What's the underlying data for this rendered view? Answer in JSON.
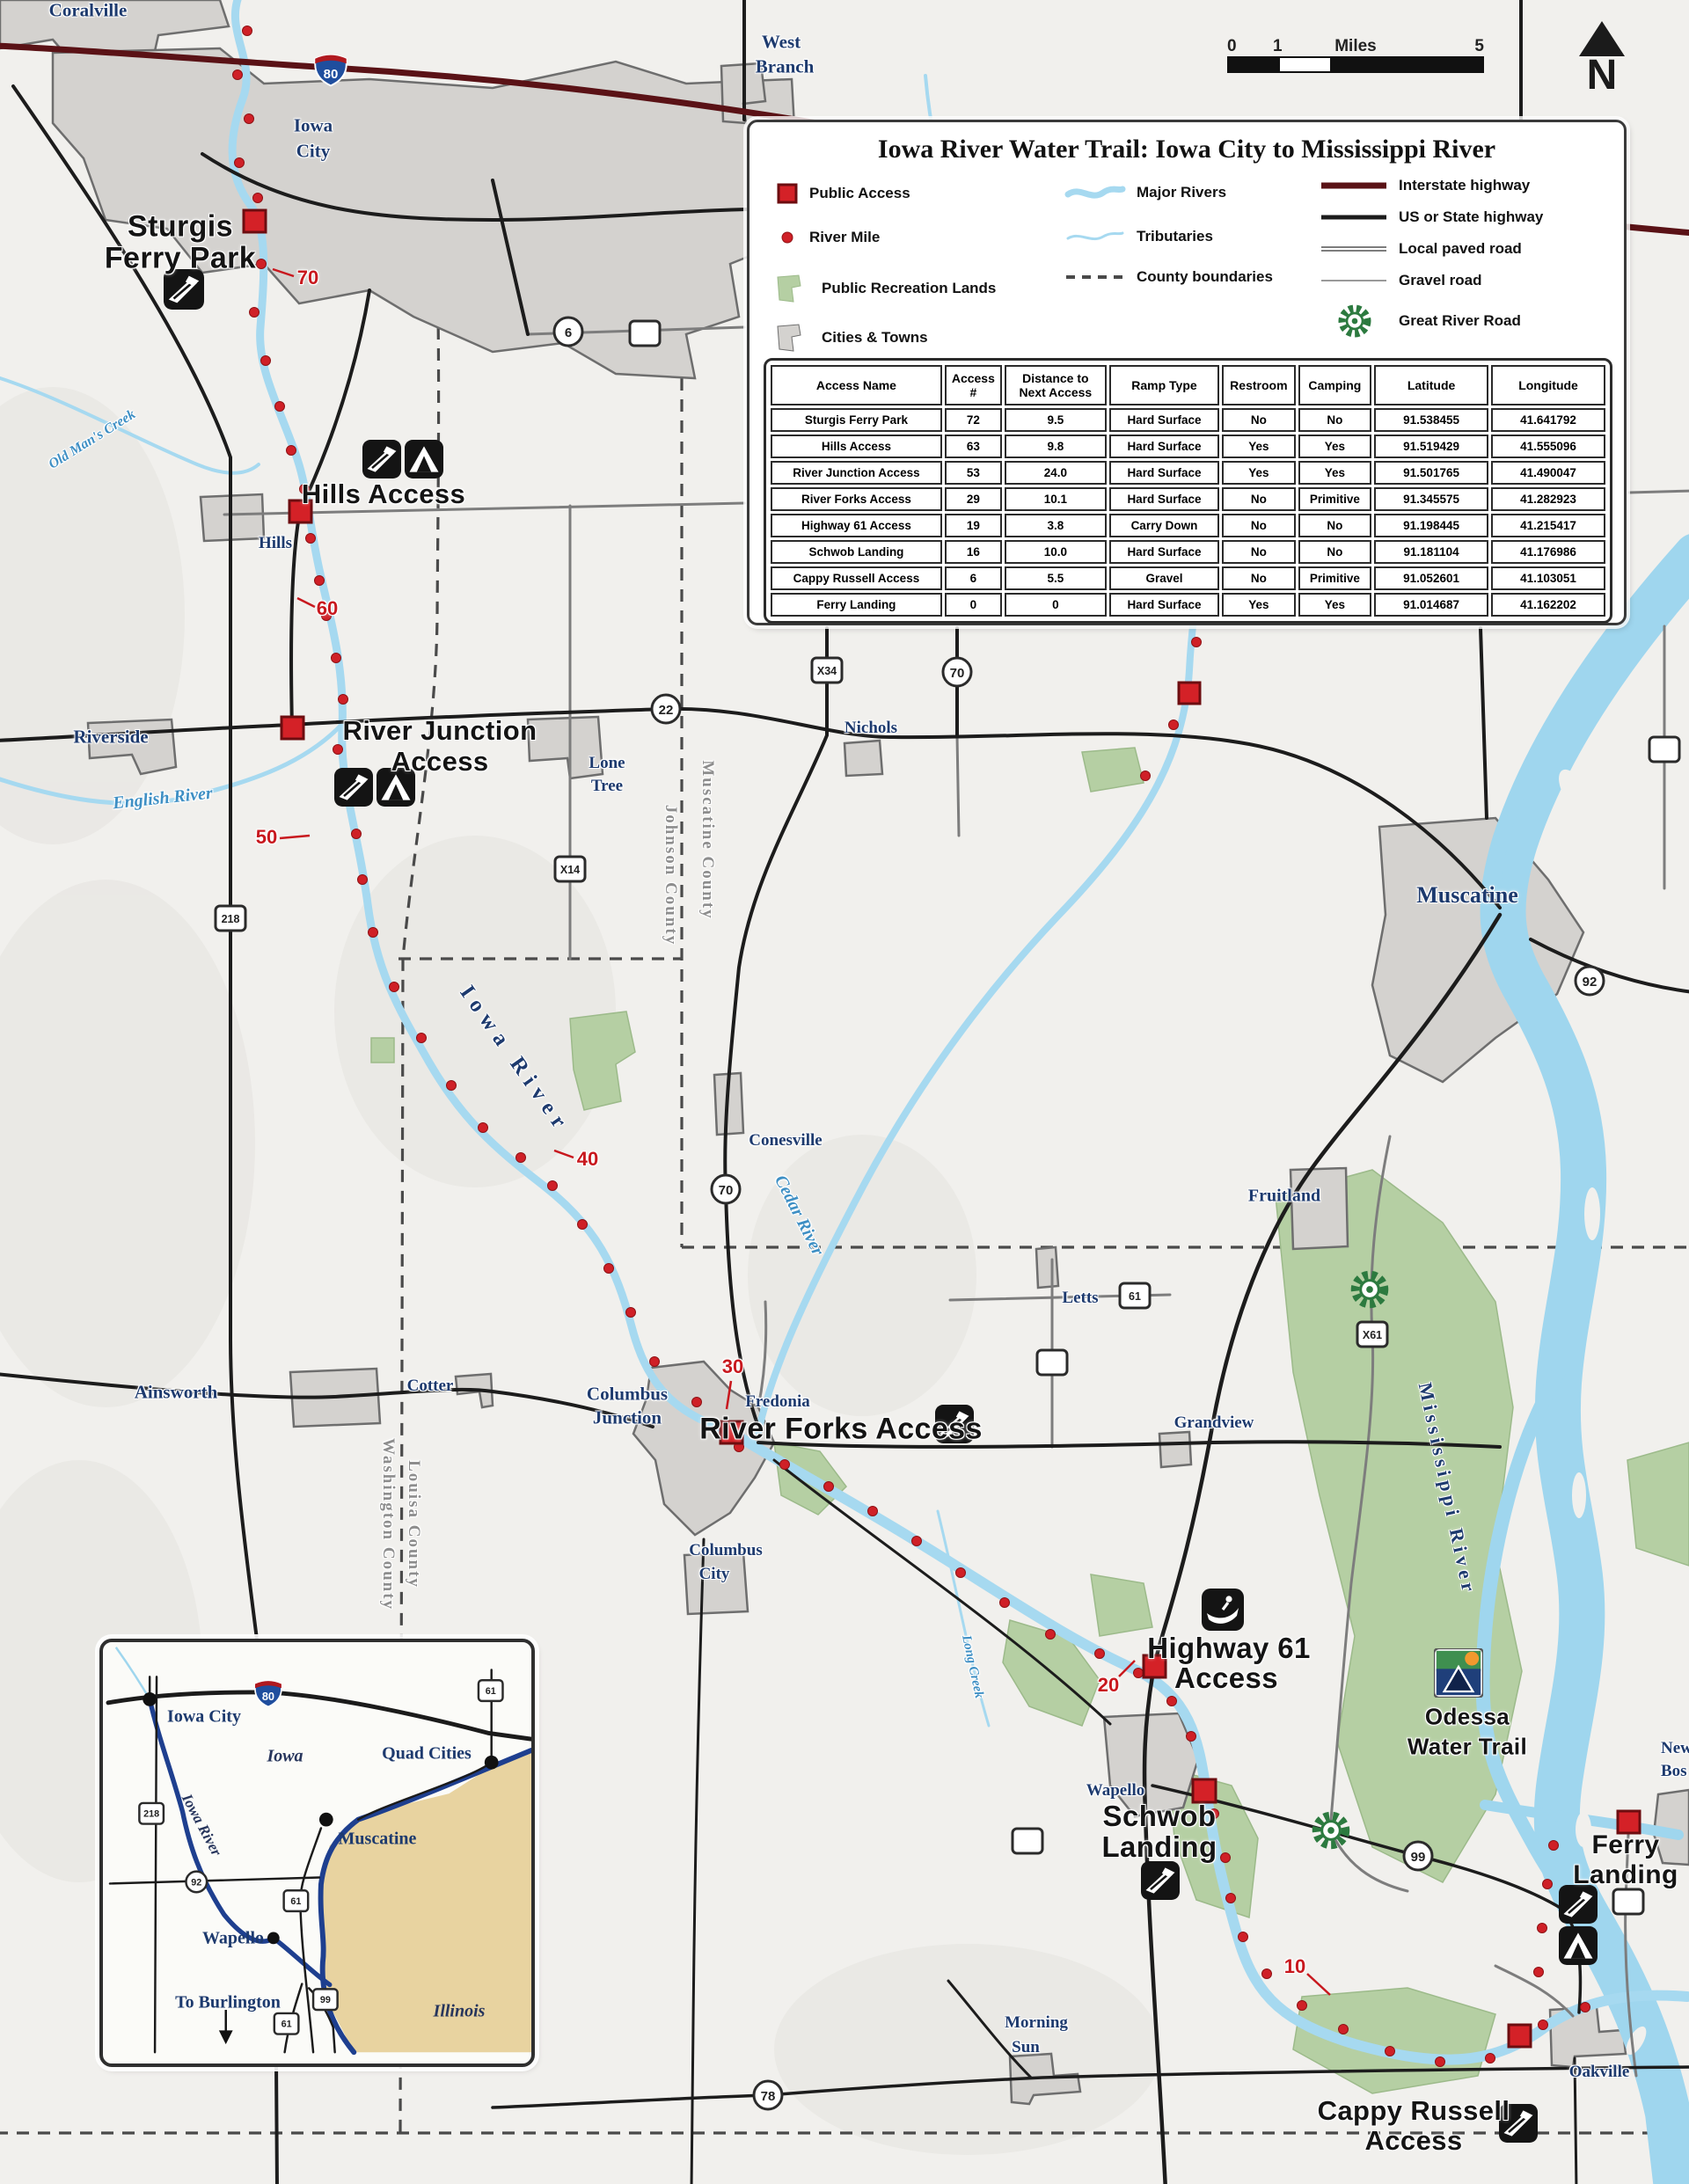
{
  "legend": {
    "title": "Iowa River Water Trail: Iowa City to Mississippi River",
    "items": {
      "public_access": "Public Access",
      "river_mile": "River Mile",
      "rec_lands": "Public Recreation Lands",
      "cities_towns": "Cities & Towns",
      "major_rivers": "Major Rivers",
      "tributaries": "Tributaries",
      "county_boundaries": "County boundaries",
      "interstate": "Interstate highway",
      "us_state": "US or State highway",
      "local_paved": "Local paved road",
      "gravel": "Gravel road",
      "great_river_road": "Great River Road"
    }
  },
  "table": {
    "headers": [
      "Access Name",
      "Access\n#",
      "Distance to\nNext Access",
      "Ramp Type",
      "Restroom",
      "Camping",
      "Latitude",
      "Longitude"
    ],
    "rows": [
      [
        "Sturgis Ferry Park",
        "72",
        "9.5",
        "Hard Surface",
        "No",
        "No",
        "91.538455",
        "41.641792"
      ],
      [
        "Hills Access",
        "63",
        "9.8",
        "Hard Surface",
        "Yes",
        "Yes",
        "91.519429",
        "41.555096"
      ],
      [
        "River Junction Access",
        "53",
        "24.0",
        "Hard Surface",
        "Yes",
        "Yes",
        "91.501765",
        "41.490047"
      ],
      [
        "River Forks Access",
        "29",
        "10.1",
        "Hard Surface",
        "No",
        "Primitive",
        "91.345575",
        "41.282923"
      ],
      [
        "Highway 61 Access",
        "19",
        "3.8",
        "Carry Down",
        "No",
        "No",
        "91.198445",
        "41.215417"
      ],
      [
        "Schwob Landing",
        "16",
        "10.0",
        "Hard Surface",
        "No",
        "No",
        "91.181104",
        "41.176986"
      ],
      [
        "Cappy Russell Access",
        "6",
        "5.5",
        "Gravel",
        "No",
        "Primitive",
        "91.052601",
        "41.103051"
      ],
      [
        "Ferry Landing",
        "0",
        "0",
        "Hard Surface",
        "Yes",
        "Yes",
        "91.014687",
        "41.162202"
      ]
    ]
  },
  "scale_bar": {
    "t0": "0",
    "t1": "1",
    "unit": "Miles",
    "t5": "5"
  },
  "north_label": "N",
  "map_labels": {
    "coralville": "Coralville",
    "iowa_city_1": "Iowa",
    "iowa_city_2": "City",
    "west_branch_1": "West",
    "west_branch_2": "Branch",
    "sturgis_1": "Sturgis",
    "sturgis_2": "Ferry Park",
    "hills_access": "Hills Access",
    "hills_town": "Hills",
    "riverside": "Riverside",
    "river_junction_1": "River Junction",
    "river_junction_2": "Access",
    "lone_tree_1": "Lone",
    "lone_tree_2": "Tree",
    "nichols": "Nichols",
    "muscatine": "Muscatine",
    "conesville": "Conesville",
    "fruitland": "Fruitland",
    "letts": "Letts",
    "grandview": "Grandview",
    "ainsworth": "Ainsworth",
    "cotter": "Cotter",
    "columbus_jct_1": "Columbus",
    "columbus_jct_2": "Junction",
    "fredonia": "Fredonia",
    "river_forks": "River Forks Access",
    "columbus_city_1": "Columbus",
    "columbus_city_2": "City",
    "wapello": "Wapello",
    "schwob_1": "Schwob",
    "schwob_2": "Landing",
    "hwy61_1": "Highway 61",
    "hwy61_2": "Access",
    "odessa_1": "Odessa",
    "odessa_2": "Water Trail",
    "morning_sun_1": "Morning",
    "morning_sun_2": "Sun",
    "oakville": "Oakville",
    "cappy_1": "Cappy Russell",
    "cappy_2": "Access",
    "ferry_1": "Ferry",
    "ferry_2": "Landing",
    "new_boston_1": "New",
    "new_boston_2": "Bos",
    "iowa_river": "Iowa River",
    "english_river": "English River",
    "cedar_river": "Cedar River",
    "mississippi_river": "Mississippi River",
    "long_creek": "Long Creek",
    "old_mans_creek": "Old Man's Creek",
    "johnson_county": "Johnson County",
    "muscatine_county": "Muscatine County",
    "washington_county": "Washington County",
    "louisa_county": "Louisa County"
  },
  "river_miles": {
    "m70": "70",
    "m60": "60",
    "m50": "50",
    "m40": "40",
    "m30": "30",
    "m20": "20",
    "m10": "10"
  },
  "shields": {
    "i80": "80",
    "s6": "6",
    "s22": "22",
    "s70a": "70",
    "s70b": "70",
    "s78": "78",
    "s92": "92",
    "s99": "99",
    "s61": "61",
    "x34": "X34",
    "x14": "X14",
    "x61": "X61",
    "s218": "218"
  },
  "inset": {
    "labels": {
      "iowa_city": "Iowa City",
      "quad_cities": "Quad Cities",
      "muscatine": "Muscatine",
      "wapello": "Wapello",
      "to_burlington": "To Burlington",
      "iowa": "Iowa",
      "illinois": "Illinois",
      "iowa_river": "Iowa River"
    },
    "shields": {
      "i80": "80",
      "s61_top": "61",
      "s218": "218",
      "s92": "92",
      "s61_mid": "61",
      "s61_bottom": "61",
      "s99": "99"
    }
  },
  "colors": {
    "access_red": "#d42127",
    "river_blue": "#a6d9f0",
    "interstate_red": "#5a1216",
    "rec_green": "#b5cfa3",
    "city_gray": "#d4d2cf",
    "inset_river": "#1e3f8f",
    "illinois_tan": "#e8d3a0"
  }
}
